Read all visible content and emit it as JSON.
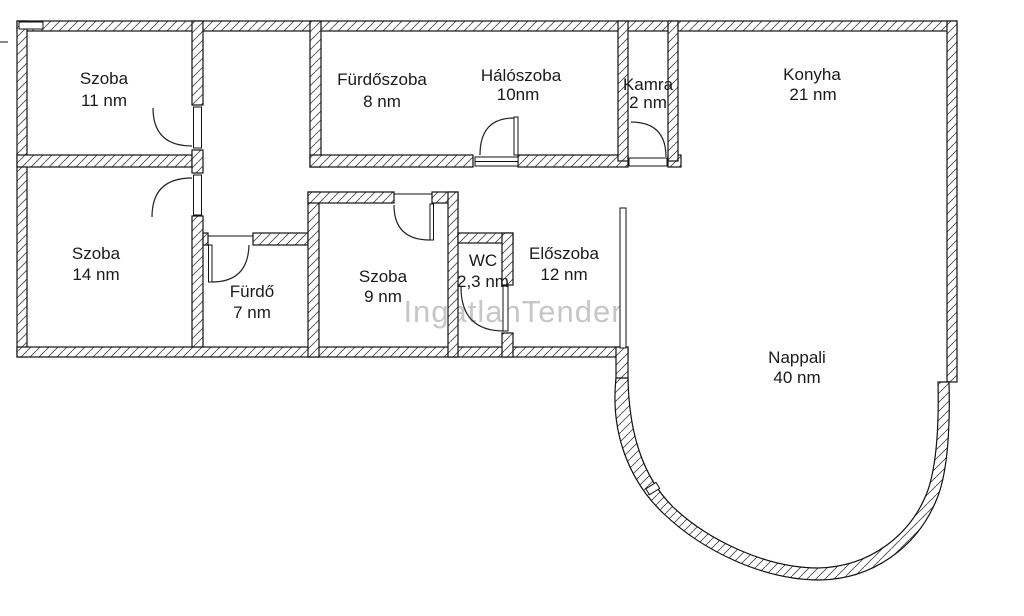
{
  "plan": {
    "watermark": "IngatlanTender",
    "colors": {
      "background": "#ffffff",
      "line": "#111111",
      "watermark": "#c7c7c7"
    },
    "unit": "nm",
    "rooms": [
      {
        "name": "Szoba",
        "area": "11 nm"
      },
      {
        "name": "Szoba",
        "area": "14 nm"
      },
      {
        "name": "Fürdőszoba",
        "area": "8 nm"
      },
      {
        "name": "Hálószoba",
        "area": "10nm"
      },
      {
        "name": "Kamra",
        "area": "2 nm"
      },
      {
        "name": "Konyha",
        "area": "21 nm"
      },
      {
        "name": "Fürdő",
        "area": "7 nm"
      },
      {
        "name": "Szoba",
        "area": "9 nm"
      },
      {
        "name": "WC",
        "area": "2,3 nm"
      },
      {
        "name": "Előszoba",
        "area": "12 nm"
      },
      {
        "name": "Nappali",
        "area": "40 nm"
      }
    ]
  }
}
